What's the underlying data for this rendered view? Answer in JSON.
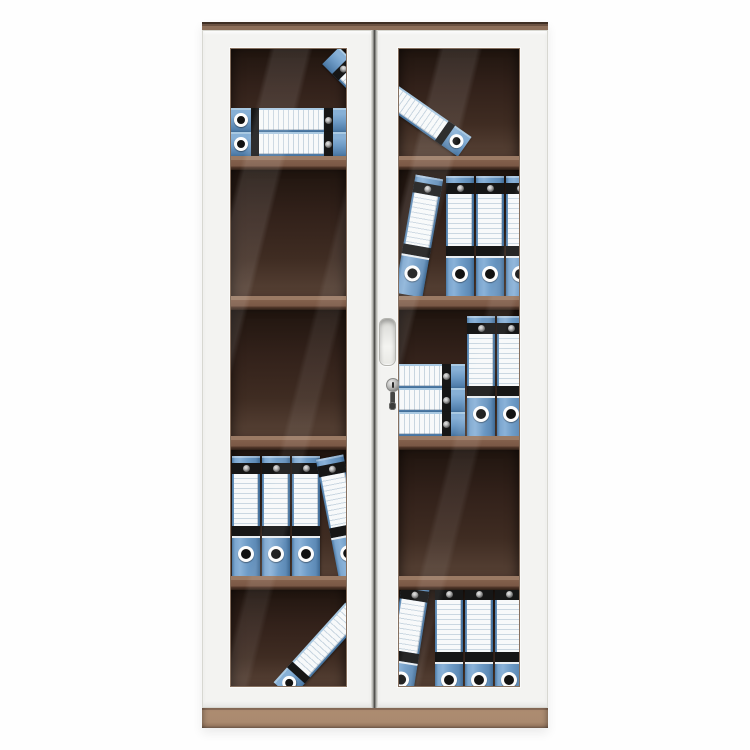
{
  "image": {
    "type": "product-photo",
    "subject": "two glass-door filing cabinet with blue lever-arch binders",
    "background_color": "#ffffff"
  },
  "palette": {
    "frame_white": "#f3f3f1",
    "top_trim_brown": "#8d6f5a",
    "top_trim_dark": "#3f2f24",
    "base_tan": "#aa8a6f",
    "interior_dark_brown": "#32211a",
    "shelf_brown": "#83604c",
    "binder_blue": "#6f9cc7",
    "binder_black": "#161616",
    "label_white": "#f7f9fa",
    "metal_gray": "#b9b9b7",
    "door_gap_dark": "#3f3f3b"
  },
  "hardware": {
    "handle": "recessed-pull-handle",
    "lock": "cylinder-keyhole",
    "key": "key-inserted-in-lock"
  },
  "shelves_per_door": 4,
  "compartments_per_door": 5,
  "binder_total_count": 24,
  "panes": [
    {
      "side": "left",
      "compartments": [
        {
          "items": [
            {
              "kind": "lying-stack",
              "count": 2,
              "left": 0,
              "bottom": 0,
              "width": 116
            },
            {
              "kind": "lying-single",
              "mirror": true,
              "angle": 45,
              "left": 85,
              "top": 30,
              "width": 100
            }
          ]
        },
        {
          "items": []
        },
        {
          "items": []
        },
        {
          "items": [
            {
              "kind": "upright-row",
              "count": 3,
              "left": 1,
              "bottom": 0
            },
            {
              "kind": "upright-single",
              "angle": -11,
              "left": 96,
              "bottom": 0
            }
          ]
        },
        {
          "items": [
            {
              "kind": "lying-single",
              "angle": -48,
              "left": 30,
              "top": 40,
              "width": 130
            }
          ]
        }
      ]
    },
    {
      "side": "right",
      "compartments": [
        {
          "items": [
            {
              "kind": "lying-single",
              "mirror": true,
              "angle": 35,
              "left": -48,
              "top": 50,
              "width": 125
            }
          ]
        },
        {
          "items": [
            {
              "kind": "upright-single",
              "angle": 10,
              "left": 6,
              "bottom": 0
            },
            {
              "kind": "upright-row",
              "count": 4,
              "left": 47,
              "bottom": 0
            }
          ]
        },
        {
          "items": [
            {
              "kind": "lying-stack",
              "count": 3,
              "left": -52,
              "bottom": 0,
              "width": 118
            },
            {
              "kind": "upright-row",
              "count": 2,
              "left": 68,
              "bottom": 0
            }
          ]
        },
        {
          "items": []
        },
        {
          "items": [
            {
              "kind": "upright-single",
              "angle": 9,
              "left": -6,
              "bottom": -16
            },
            {
              "kind": "upright-row",
              "count": 4,
              "left": 36,
              "bottom": -16
            }
          ]
        }
      ]
    }
  ]
}
